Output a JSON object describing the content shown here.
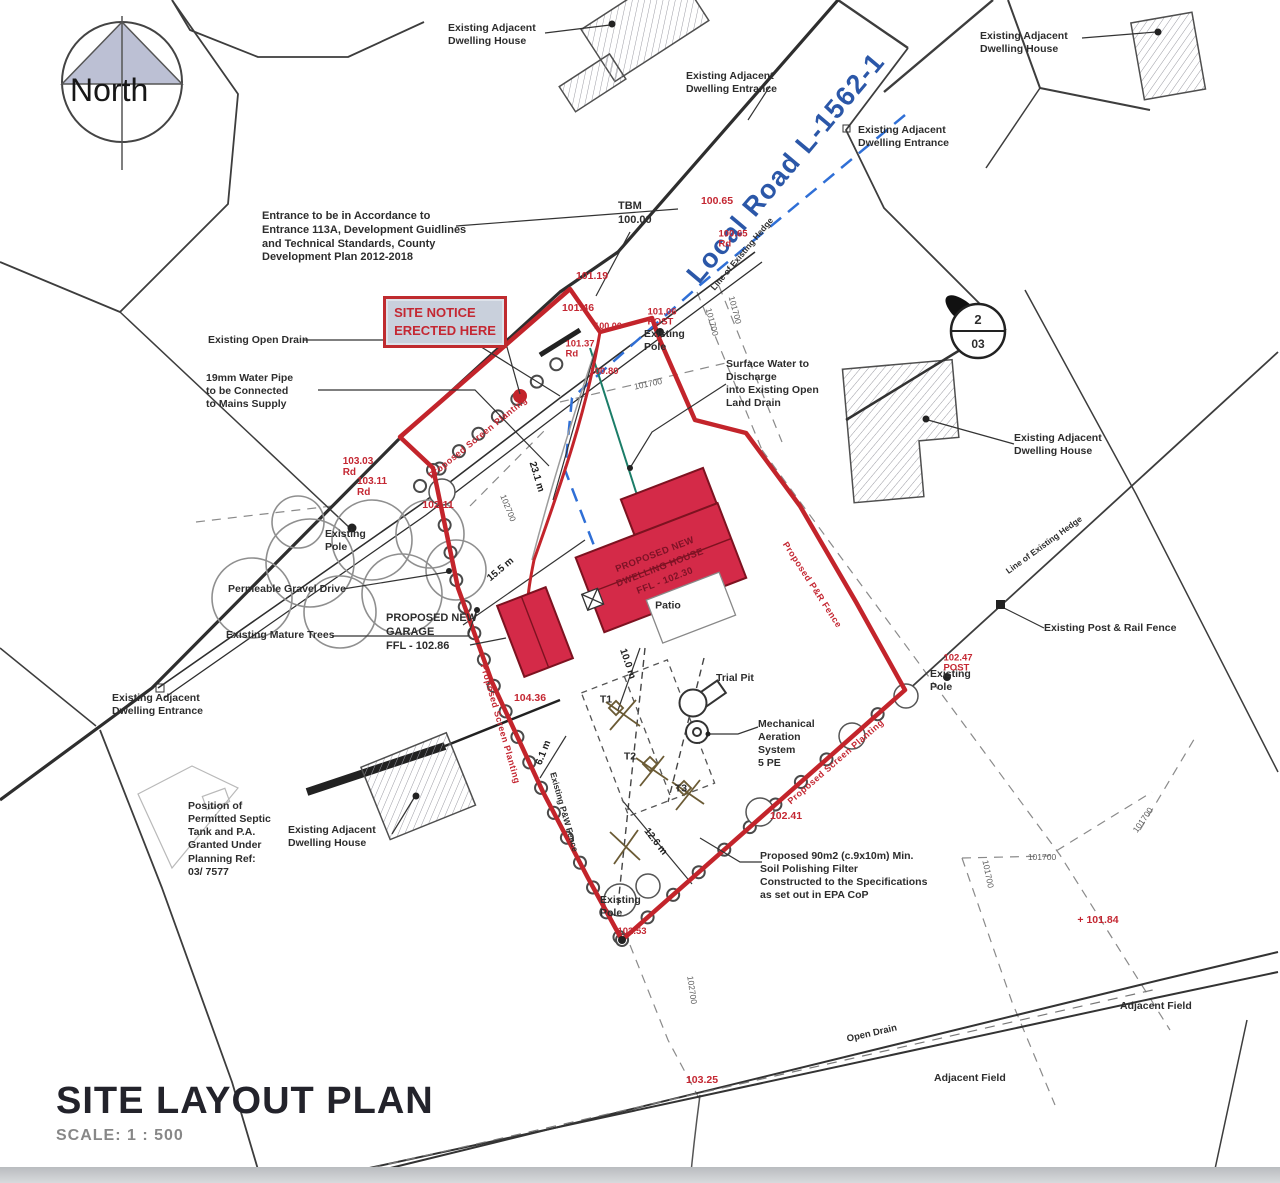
{
  "title_block": {
    "title": "SITE LAYOUT PLAN",
    "scale": "SCALE:   1 : 500"
  },
  "compass": {
    "label": "North"
  },
  "site_notice": {
    "text": "SITE NOTICE\nERECTED HERE"
  },
  "section_marker": {
    "top": "2",
    "bottom": "03"
  },
  "colors": {
    "boundary_red": "#c3242b",
    "building_fill": "#d42a48",
    "road_label_blue": "#2b57a8",
    "level_red": "#c42732",
    "notice_fill": "#c9d0dc"
  },
  "annotations": [
    {
      "n": "label-dwelling-house-top-left",
      "t": "Existing Adjacent\nDwelling House",
      "x": 448,
      "y": 22,
      "a": "tl",
      "c": "bk"
    },
    {
      "n": "label-dwelling-entrance-top",
      "t": "Existing Adjacent\nDwelling Entrance",
      "x": 686,
      "y": 70,
      "a": "tl",
      "c": "bk"
    },
    {
      "n": "label-dwelling-house-top-right",
      "t": "Existing Adjacent\nDwelling House",
      "x": 980,
      "y": 30,
      "a": "tl",
      "c": "bk"
    },
    {
      "n": "label-dwelling-entrance-right",
      "t": "Existing Adjacent\nDwelling Entrance",
      "x": 858,
      "y": 124,
      "a": "tl",
      "c": "bk"
    },
    {
      "n": "label-tbm",
      "t": "TBM\n100.00",
      "x": 618,
      "y": 200,
      "a": "tl",
      "c": "bk",
      "fs": 11
    },
    {
      "n": "note-entrance",
      "t": "Entrance to be in Accordance to\nEntrance 113A, Development Guidlines\nand Technical Standards, County\nDevelopment Plan 2012-2018",
      "x": 262,
      "y": 210,
      "a": "tl",
      "c": "bk",
      "fs": 11
    },
    {
      "n": "label-open-drain",
      "t": "Existing Open Drain",
      "x": 208,
      "y": 334,
      "a": "tl",
      "c": "bk"
    },
    {
      "n": "note-water-pipe",
      "t": "19mm Water Pipe\nto be Connected\nto Mains Supply",
      "x": 206,
      "y": 372,
      "a": "tl",
      "c": "bk"
    },
    {
      "n": "label-road-name",
      "t": "Local Road L-1562-1",
      "x": 786,
      "y": 168,
      "r": -50,
      "c": "blue"
    },
    {
      "n": "label-hedge-top",
      "t": "Line of Existing Hedge",
      "x": 742,
      "y": 254,
      "r": -50,
      "c": "bk",
      "fs": 8.5
    },
    {
      "n": "note-surface-water",
      "t": "Surface Water to\nDischarge\ninto Existing Open\nLand Drain",
      "x": 726,
      "y": 358,
      "a": "tl",
      "c": "bk"
    },
    {
      "n": "label-pole-center",
      "t": "Existing\nPole",
      "x": 644,
      "y": 328,
      "a": "tl",
      "c": "bk"
    },
    {
      "n": "label-dwelling-house-right",
      "t": "Existing Adjacent\nDwelling House",
      "x": 1014,
      "y": 432,
      "a": "tl",
      "c": "bk"
    },
    {
      "n": "label-hedge-right",
      "t": "Line of Existing Hedge",
      "x": 1044,
      "y": 545,
      "r": -36,
      "c": "bk",
      "fs": 8.5
    },
    {
      "n": "label-post-rail-fence",
      "t": "Existing Post & Rail Fence",
      "x": 1044,
      "y": 622,
      "a": "tl",
      "c": "bk"
    },
    {
      "n": "label-pole-right",
      "t": "Existing\nPole",
      "x": 930,
      "y": 668,
      "a": "tl",
      "c": "bk"
    },
    {
      "n": "label-pole-left",
      "t": "Existing\nPole",
      "x": 325,
      "y": 528,
      "a": "tl",
      "c": "bk"
    },
    {
      "n": "label-gravel-drive",
      "t": "Permeable Gravel Drive",
      "x": 228,
      "y": 583,
      "a": "tl",
      "c": "bk"
    },
    {
      "n": "label-mature-trees",
      "t": "Existing Mature Trees",
      "x": 226,
      "y": 629,
      "a": "tl",
      "c": "bk"
    },
    {
      "n": "label-garage",
      "t": "PROPOSED NEW\nGARAGE\nFFL - 102.86",
      "x": 386,
      "y": 612,
      "a": "tl",
      "c": "bk",
      "fs": 11
    },
    {
      "n": "label-house",
      "t": "PROPOSED NEW\nDWELLING HOUSE\nFFL - 102.30",
      "x": 660,
      "y": 568,
      "r": -21,
      "c": "dkred"
    },
    {
      "n": "label-patio",
      "t": "Patio",
      "x": 668,
      "y": 606,
      "c": "bk"
    },
    {
      "n": "label-trial-pit",
      "t": "Trial Pit",
      "x": 716,
      "y": 672,
      "a": "tl",
      "c": "bk"
    },
    {
      "n": "label-t1",
      "t": "T1",
      "x": 606,
      "y": 700,
      "c": "bk"
    },
    {
      "n": "label-t2",
      "t": "T2",
      "x": 630,
      "y": 757,
      "c": "bk"
    },
    {
      "n": "label-t3",
      "t": "T3",
      "x": 681,
      "y": 789,
      "c": "bk"
    },
    {
      "n": "note-mechanical",
      "t": "Mechanical\nAeration\nSystem\n5 PE",
      "x": 758,
      "y": 718,
      "a": "tl",
      "c": "bk"
    },
    {
      "n": "note-soil-filter",
      "t": "Proposed 90m2 (c.9x10m) Min.\nSoil Polishing Filter\nConstructed to the Specifications\nas set out in EPA CoP",
      "x": 760,
      "y": 850,
      "a": "tl",
      "c": "bk"
    },
    {
      "n": "note-septic",
      "t": "Position of\nPermitted Septic\nTank and P.A.\nGranted Under\nPlanning Ref:\n03/ 7577",
      "x": 188,
      "y": 800,
      "a": "tl",
      "c": "bk"
    },
    {
      "n": "label-dwelling-house-bottom-left",
      "t": "Existing Adjacent\nDwelling House",
      "x": 288,
      "y": 824,
      "a": "tl",
      "c": "bk"
    },
    {
      "n": "label-dwelling-entrance-left",
      "t": "Existing Adjacent\nDwelling Entrance",
      "x": 112,
      "y": 692,
      "a": "tl",
      "c": "bk"
    },
    {
      "n": "label-pole-bottom",
      "t": "Existing\nPole",
      "x": 600,
      "y": 894,
      "a": "tl",
      "c": "bk"
    },
    {
      "n": "label-adjacent-field-1",
      "t": "Adjacent Field",
      "x": 1120,
      "y": 1000,
      "a": "tl",
      "c": "bk"
    },
    {
      "n": "label-adjacent-field-2",
      "t": "Adjacent Field",
      "x": 934,
      "y": 1072,
      "a": "tl",
      "c": "bk"
    },
    {
      "n": "label-open-drain-bottom",
      "t": "Open Drain",
      "x": 872,
      "y": 1034,
      "r": -13,
      "c": "bk",
      "fs": 9.5
    },
    {
      "n": "label-screen-planting-1",
      "t": "Proposed Screen Planting",
      "x": 478,
      "y": 438,
      "r": -39,
      "c": "redrot"
    },
    {
      "n": "label-screen-planting-2",
      "t": "Proposed Screen Planting",
      "x": 500,
      "y": 724,
      "r": 74,
      "c": "redrot"
    },
    {
      "n": "label-screen-planting-3",
      "t": "Proposed Screen Planting",
      "x": 836,
      "y": 762,
      "r": -41,
      "c": "redrot"
    },
    {
      "n": "label-pr-fence",
      "t": "Proposed P&R Fence",
      "x": 812,
      "y": 585,
      "r": 57,
      "c": "redrot"
    },
    {
      "n": "label-pw-fence",
      "t": "Existing P&W Fence",
      "x": 564,
      "y": 812,
      "r": 74,
      "c": "bk",
      "fs": 8.5
    },
    {
      "n": "dim-23-1",
      "t": "23.1 m",
      "x": 536,
      "y": 477,
      "r": 73,
      "c": "dim"
    },
    {
      "n": "dim-15-5",
      "t": "15.5 m",
      "x": 501,
      "y": 570,
      "r": -40,
      "c": "dim"
    },
    {
      "n": "dim-10-0",
      "t": "10.0 m",
      "x": 627,
      "y": 664,
      "r": 71,
      "c": "dim"
    },
    {
      "n": "dim-6-1",
      "t": "6.1 m",
      "x": 544,
      "y": 753,
      "r": -68,
      "c": "dim"
    },
    {
      "n": "dim-12-6",
      "t": "12.6 m",
      "x": 655,
      "y": 842,
      "r": 52,
      "c": "dim"
    },
    {
      "n": "grid-101700-a",
      "t": "101700",
      "x": 712,
      "y": 322,
      "r": 75,
      "c": "grid"
    },
    {
      "n": "grid-101700-b",
      "t": "101700",
      "x": 735,
      "y": 310,
      "r": 75,
      "c": "grid"
    },
    {
      "n": "grid-101700-c",
      "t": "101700",
      "x": 648,
      "y": 384,
      "r": -12,
      "c": "grid"
    },
    {
      "n": "grid-102700-a",
      "t": "102700",
      "x": 508,
      "y": 508,
      "r": 68,
      "c": "grid"
    },
    {
      "n": "grid-101700-d",
      "t": "101700",
      "x": 1042,
      "y": 857,
      "r": 0,
      "c": "grid"
    },
    {
      "n": "grid-101700-e",
      "t": "101700",
      "x": 988,
      "y": 874,
      "r": 78,
      "c": "grid"
    },
    {
      "n": "grid-101700-f",
      "t": "101700",
      "x": 1143,
      "y": 820,
      "r": -55,
      "c": "grid"
    },
    {
      "n": "grid-102700-b",
      "t": "102700",
      "x": 692,
      "y": 990,
      "r": 82,
      "c": "grid"
    },
    {
      "n": "level-100-65",
      "t": "100.65",
      "x": 717,
      "y": 202,
      "c": "red"
    },
    {
      "n": "level-100-65-rd",
      "t": "100.65\nRd",
      "x": 733,
      "y": 240,
      "c": "red",
      "fs": 9.5
    },
    {
      "n": "level-101-19",
      "t": "101.19",
      "x": 592,
      "y": 277,
      "c": "red"
    },
    {
      "n": "level-101-46",
      "t": "101.46",
      "x": 578,
      "y": 309,
      "c": "red"
    },
    {
      "n": "level-100-06",
      "t": "100.06",
      "x": 608,
      "y": 327,
      "c": "red",
      "fs": 9
    },
    {
      "n": "level-101-06",
      "t": "101.06\nPOST",
      "x": 662,
      "y": 318,
      "c": "red",
      "fs": 9.5
    },
    {
      "n": "level-101-37",
      "t": "101.37\nRd",
      "x": 580,
      "y": 350,
      "c": "red",
      "fs": 9.5
    },
    {
      "n": "level-100-80",
      "t": "100.80",
      "x": 604,
      "y": 372,
      "c": "red",
      "fs": 9.5
    },
    {
      "n": "level-103-03",
      "t": "103.03\nRd",
      "x": 358,
      "y": 467,
      "c": "red",
      "fs": 10
    },
    {
      "n": "level-103-11",
      "t": "103.11\nRd",
      "x": 372,
      "y": 487,
      "c": "red",
      "fs": 10
    },
    {
      "n": "level-102-11",
      "t": "102.11",
      "x": 438,
      "y": 506,
      "c": "red"
    },
    {
      "n": "level-104-36",
      "t": "104.36",
      "x": 530,
      "y": 699,
      "c": "red"
    },
    {
      "n": "level-102-41",
      "t": "102.41",
      "x": 786,
      "y": 817,
      "c": "red"
    },
    {
      "n": "level-102-47",
      "t": "102.47\nPOST",
      "x": 958,
      "y": 664,
      "c": "red",
      "fs": 9.5
    },
    {
      "n": "level-102-53",
      "t": "102.53",
      "x": 632,
      "y": 932,
      "c": "red",
      "fs": 9.5
    },
    {
      "n": "level-103-25",
      "t": "103.25",
      "x": 702,
      "y": 1081,
      "c": "red"
    },
    {
      "n": "level-101-84",
      "t": "+ 101.84",
      "x": 1098,
      "y": 921,
      "c": "red"
    }
  ]
}
